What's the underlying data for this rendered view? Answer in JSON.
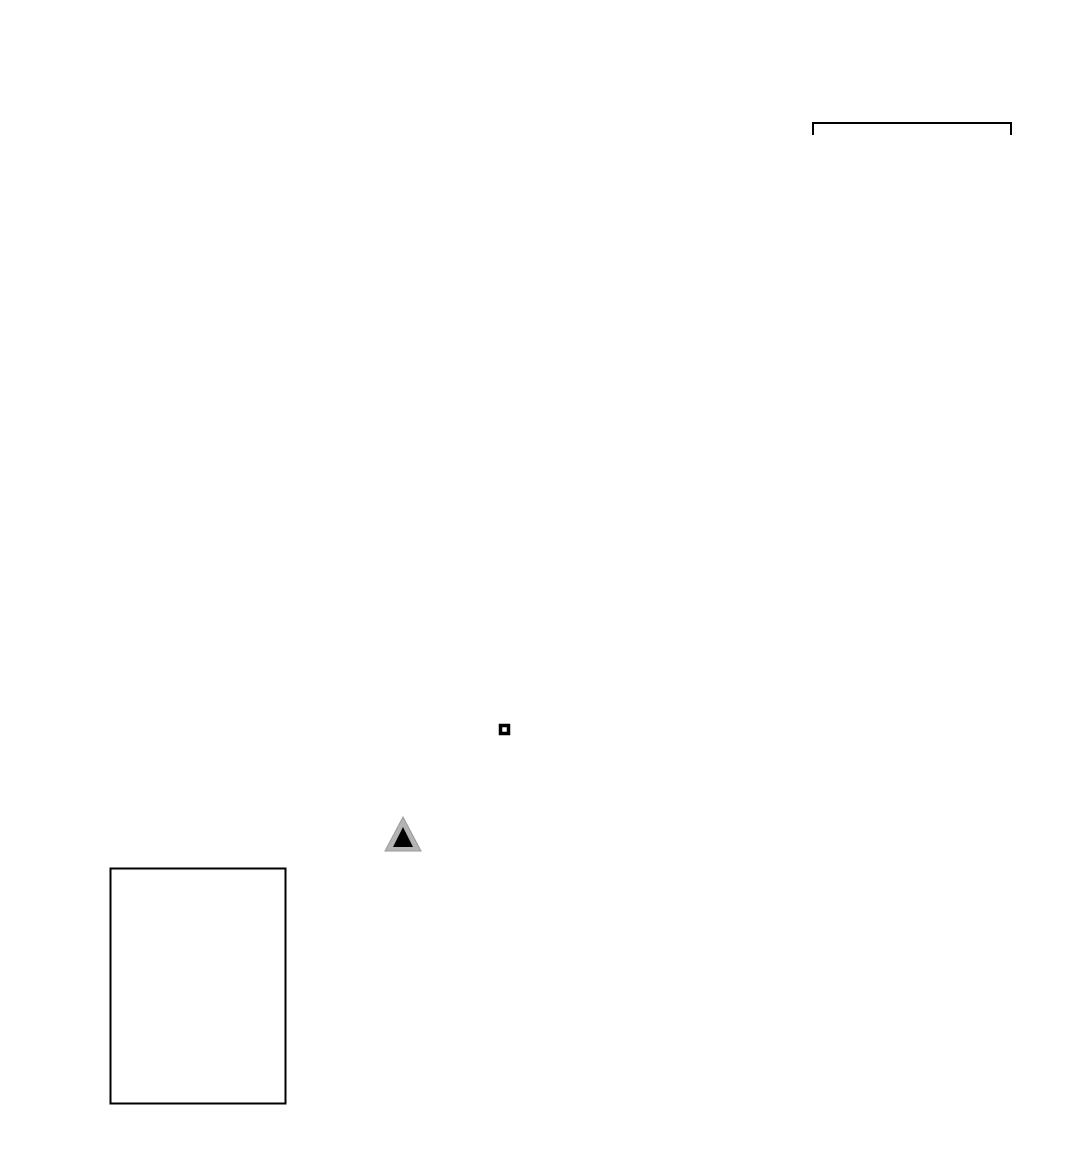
{
  "colors": {
    "epicenter_fill": "#ff0000",
    "marker_stroke": "#000000",
    "station_outer_gray": "#b4b4b4",
    "station_inner": "#000000",
    "frame_black": "#000000",
    "frame_white": "#ffffff"
  },
  "map": {
    "axis_labels": {
      "lat_top": "31°30'",
      "lat_bottom": "30°00'",
      "lon_left": "57°00'",
      "lon_right": "58°30'"
    },
    "scale_bar": {
      "label": "60 km"
    },
    "city": {
      "name": "Kerman"
    },
    "legend": {
      "title": "Magnitude",
      "entries": [
        {
          "magnitude": "3",
          "radius_px": 11
        },
        {
          "magnitude": "4",
          "radius_px": 15
        },
        {
          "magnitude": "5",
          "radius_px": 18
        },
        {
          "magnitude": "6",
          "radius_px": 22
        },
        {
          "magnitude": "7",
          "radius_px": 26
        }
      ]
    },
    "epicenters": [
      {
        "x_px": 538,
        "y_px": 538,
        "radius_px": 10,
        "magnitude_est": 2.7
      },
      {
        "x_px": 563,
        "y_px": 536,
        "radius_px": 16,
        "magnitude_est": 4.3
      },
      {
        "x_px": 588,
        "y_px": 545,
        "radius_px": 13,
        "magnitude_est": 3.5
      },
      {
        "x_px": 603,
        "y_px": 540,
        "radius_px": 10,
        "magnitude_est": 2.7
      },
      {
        "x_px": 613,
        "y_px": 551,
        "radius_px": 11,
        "magnitude_est": 3.0
      },
      {
        "x_px": 573,
        "y_px": 560,
        "radius_px": 9,
        "magnitude_est": 2.4
      },
      {
        "x_px": 568,
        "y_px": 570,
        "radius_px": 9,
        "magnitude_est": 2.4
      },
      {
        "x_px": 590,
        "y_px": 568,
        "radius_px": 10,
        "magnitude_est": 2.7
      },
      {
        "x_px": 610,
        "y_px": 562,
        "radius_px": 10,
        "magnitude_est": 2.7
      },
      {
        "x_px": 597,
        "y_px": 577,
        "radius_px": 12,
        "magnitude_est": 3.2
      },
      {
        "x_px": 586,
        "y_px": 586,
        "radius_px": 10,
        "magnitude_est": 2.7
      },
      {
        "x_px": 618,
        "y_px": 580,
        "radius_px": 13,
        "magnitude_est": 3.5
      },
      {
        "x_px": 622,
        "y_px": 598,
        "radius_px": 16,
        "magnitude_est": 4.3
      },
      {
        "x_px": 600,
        "y_px": 633,
        "radius_px": 10,
        "magnitude_est": 2.7
      },
      {
        "x_px": 661,
        "y_px": 761,
        "radius_px": 9,
        "magnitude_est": 2.4
      },
      {
        "x_px": 659,
        "y_px": 797,
        "radius_px": 10,
        "magnitude_est": 2.7
      }
    ]
  }
}
